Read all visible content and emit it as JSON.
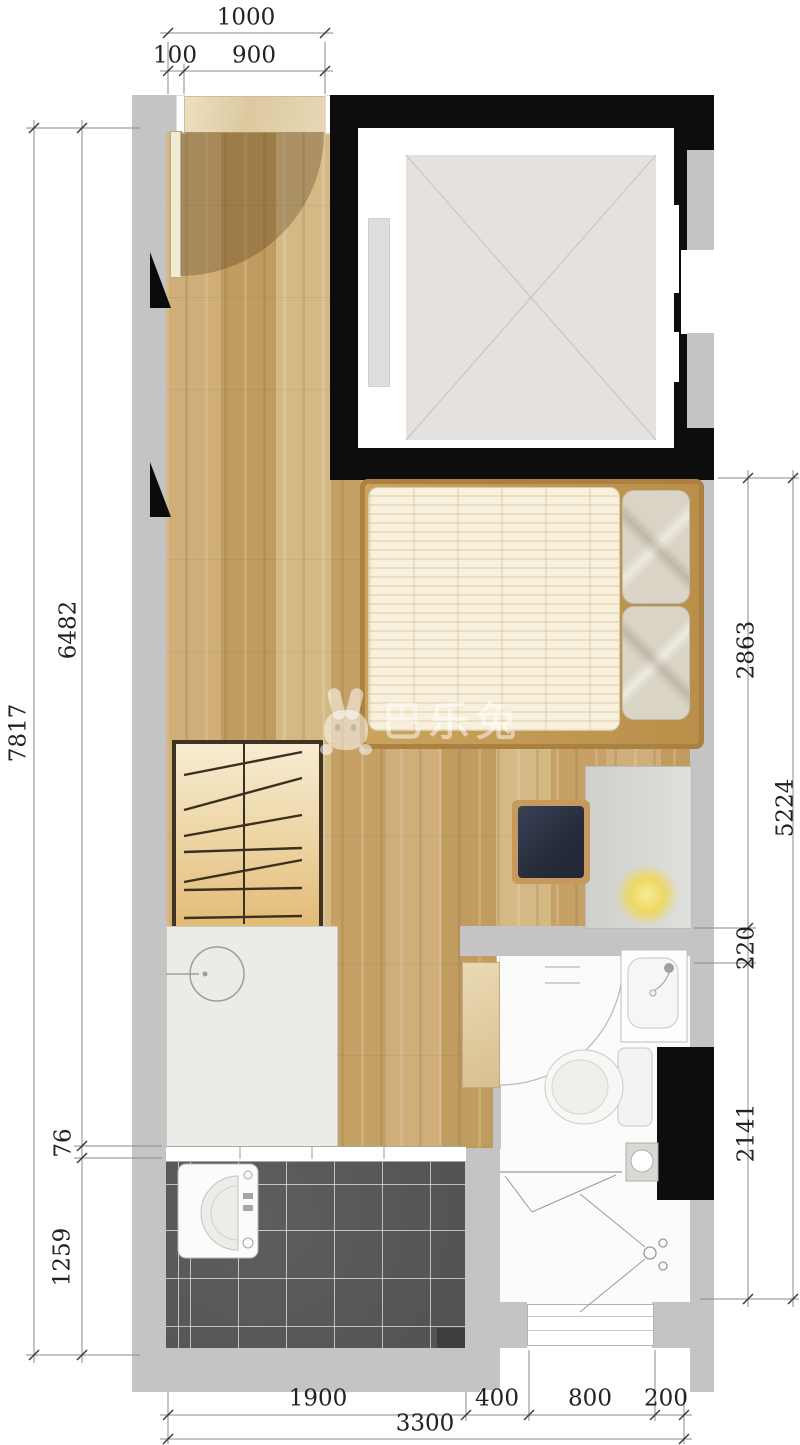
{
  "title": "studio-apartment-floor-plan",
  "watermark": {
    "icon": "rabbit-logo",
    "text": "巴乐兔"
  },
  "dims": {
    "top_total": "1000",
    "top_a": "100",
    "top_b": "900",
    "left_total": "7817",
    "left_a": "6482",
    "left_b": "76",
    "left_c": "1259",
    "right_a": "2863",
    "right_b": "220",
    "right_c": "2141",
    "right_total": "5224",
    "bottom_a": "1900",
    "bottom_b": "400",
    "bottom_c": "800",
    "bottom_d": "200",
    "bottom_total": "3300"
  },
  "colors": {
    "wall_gray": "#c4c4c4",
    "shaft_black": "#0d0d0d",
    "wood_floor": "#c9a870",
    "balcony_tile": "#575757",
    "threshold_beige": "#e9dab6",
    "mattress_cream": "#f4eed9",
    "pillow_beige": "#dad4c6",
    "chair_navy": "#2c3140",
    "lamp_glow": "#f0e07c",
    "wardrobe_wood": "#e9cd96",
    "dim_text": "#222222",
    "watermark_white": "rgba(255,255,255,0.52)"
  }
}
